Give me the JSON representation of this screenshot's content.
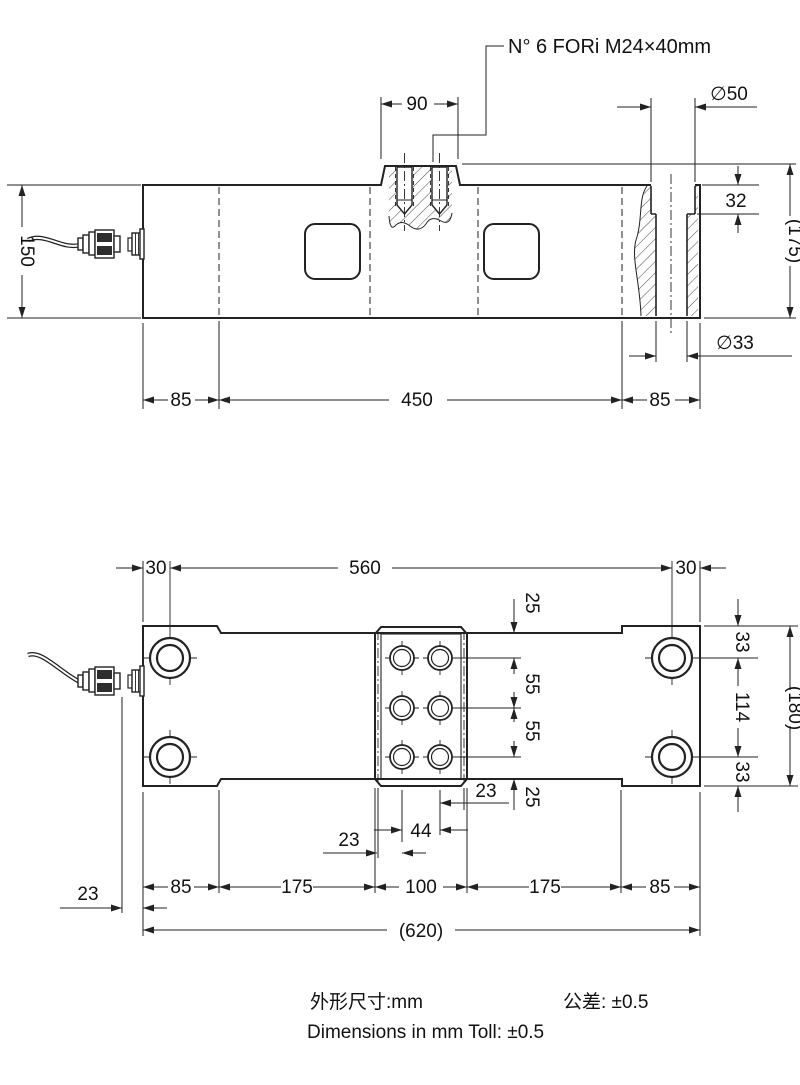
{
  "side": {
    "callout": "N° 6 FORi M24×40mm",
    "d90": "90",
    "dia50": "∅50",
    "d32": "32",
    "h175": "(175)",
    "h150": "150",
    "dia33": "∅33",
    "b85l": "85",
    "b450": "450",
    "b85r": "85"
  },
  "top": {
    "t30l": "30",
    "t560": "560",
    "t30r": "30",
    "n25t": "25",
    "p55a": "55",
    "p55b": "55",
    "n25b": "25",
    "e23r": "23",
    "c44": "44",
    "e23l": "23",
    "conn23": "23",
    "c85l": "85",
    "c175l": "175",
    "c100": "100",
    "c175r": "175",
    "c85r": "85",
    "c620": "(620)",
    "r33t": "33",
    "r114": "114",
    "r33b": "33",
    "r180": "(180)"
  },
  "footer": {
    "cn_size": "外形尺寸:mm",
    "cn_tol": "公差: ±0.5",
    "en": "Dimensions in mm  Toll:  ±0.5"
  },
  "colors": {
    "body": "#dcdcdc",
    "pocket": "#b3b3b3",
    "line": "#222222",
    "dark_band": "#2e2e2e"
  }
}
